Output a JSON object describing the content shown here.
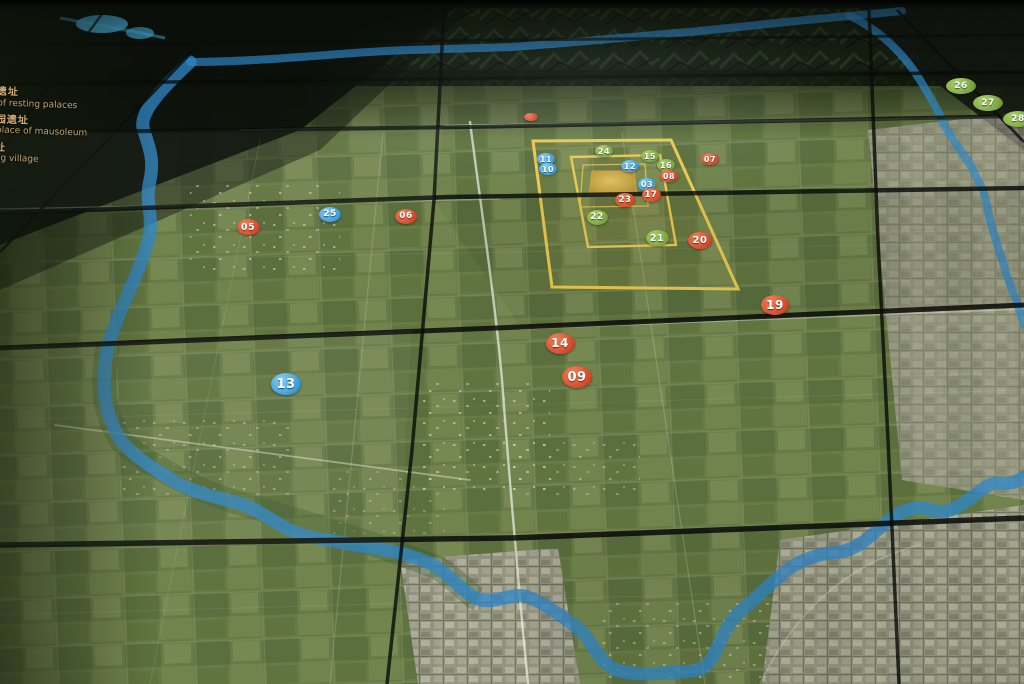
{
  "legend": {
    "items": [
      {
        "zh": "宫遗址",
        "en": "te of resting palaces"
      },
      {
        "zh": "陵园遗址",
        "en": "of place of mausoleum"
      },
      {
        "zh": "遗址",
        "en": "heng village"
      },
      {
        "zh": "",
        "en": "ank"
      }
    ]
  },
  "markers": [
    {
      "label": "",
      "color": "red",
      "x": 531,
      "y": 117,
      "rx": 7,
      "ry": 4,
      "fs": 6
    },
    {
      "label": "26",
      "color": "green",
      "x": 961,
      "y": 86,
      "rx": 15,
      "ry": 8,
      "fs": 9
    },
    {
      "label": "27",
      "color": "green",
      "x": 988,
      "y": 103,
      "rx": 15,
      "ry": 8,
      "fs": 9
    },
    {
      "label": "28",
      "color": "green",
      "x": 1018,
      "y": 119,
      "rx": 15,
      "ry": 8,
      "fs": 9
    },
    {
      "label": "24",
      "color": "green",
      "x": 604,
      "y": 151,
      "rx": 9,
      "ry": 6,
      "fs": 8
    },
    {
      "label": "15",
      "color": "green",
      "x": 650,
      "y": 156,
      "rx": 9,
      "ry": 6,
      "fs": 8
    },
    {
      "label": "16",
      "color": "green",
      "x": 666,
      "y": 165,
      "rx": 9,
      "ry": 6,
      "fs": 8
    },
    {
      "label": "11",
      "color": "blue",
      "x": 546,
      "y": 159,
      "rx": 9,
      "ry": 6,
      "fs": 8
    },
    {
      "label": "10",
      "color": "blue",
      "x": 548,
      "y": 169,
      "rx": 9,
      "ry": 6,
      "fs": 8
    },
    {
      "label": "12",
      "color": "blue",
      "x": 630,
      "y": 166,
      "rx": 9,
      "ry": 6,
      "fs": 8
    },
    {
      "label": "07",
      "color": "red",
      "x": 710,
      "y": 159,
      "rx": 9,
      "ry": 6,
      "fs": 8
    },
    {
      "label": "08",
      "color": "red",
      "x": 669,
      "y": 176,
      "rx": 9,
      "ry": 6,
      "fs": 8
    },
    {
      "label": "03",
      "color": "blue",
      "x": 647,
      "y": 184,
      "rx": 9,
      "ry": 6.5,
      "fs": 8
    },
    {
      "label": "17",
      "color": "red",
      "x": 651,
      "y": 195,
      "rx": 9.5,
      "ry": 7,
      "fs": 8.5
    },
    {
      "label": "23",
      "color": "red",
      "x": 625,
      "y": 200,
      "rx": 10,
      "ry": 7,
      "fs": 8.5
    },
    {
      "label": "22",
      "color": "green",
      "x": 597,
      "y": 217,
      "rx": 10.5,
      "ry": 7.5,
      "fs": 9
    },
    {
      "label": "25",
      "color": "blue",
      "x": 330,
      "y": 214,
      "rx": 11,
      "ry": 7.5,
      "fs": 9
    },
    {
      "label": "06",
      "color": "red",
      "x": 406,
      "y": 216,
      "rx": 11,
      "ry": 7.5,
      "fs": 9
    },
    {
      "label": "05",
      "color": "red",
      "x": 248,
      "y": 227,
      "rx": 11.5,
      "ry": 8,
      "fs": 9.5
    },
    {
      "label": "21",
      "color": "green",
      "x": 657,
      "y": 238,
      "rx": 11.5,
      "ry": 8,
      "fs": 9.5
    },
    {
      "label": "20",
      "color": "red",
      "x": 700,
      "y": 240,
      "rx": 12,
      "ry": 8.5,
      "fs": 10
    },
    {
      "label": "19",
      "color": "red",
      "x": 775,
      "y": 305,
      "rx": 14,
      "ry": 10,
      "fs": 12
    },
    {
      "label": "14",
      "color": "red",
      "x": 560,
      "y": 343,
      "rx": 14.5,
      "ry": 10.5,
      "fs": 12
    },
    {
      "label": "09",
      "color": "red",
      "x": 577,
      "y": 377,
      "rx": 15,
      "ry": 11,
      "fs": 13
    },
    {
      "label": "13",
      "color": "blue",
      "x": 286,
      "y": 384,
      "rx": 15,
      "ry": 11,
      "fs": 13
    }
  ],
  "colors": {
    "marker_red": "#d2492b",
    "marker_blue": "#3e9cd9",
    "marker_green": "#7aa63e",
    "wall_yellow": "#e9ca52",
    "river_blue": "#5bb8f0",
    "legend_text": "#d2ab74"
  }
}
